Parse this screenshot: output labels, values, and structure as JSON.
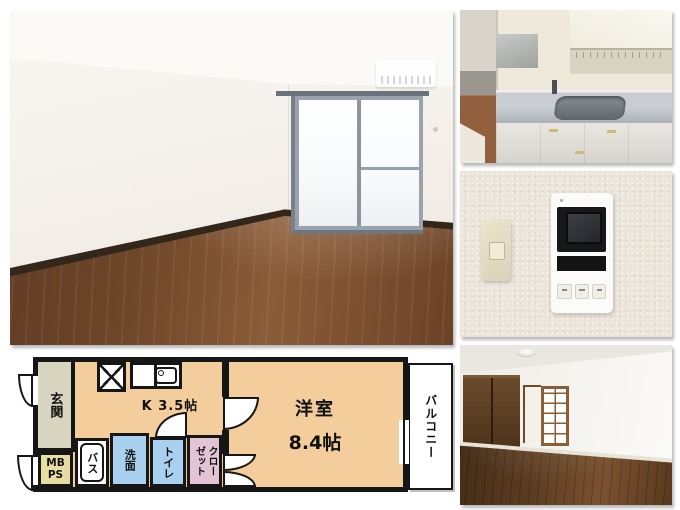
{
  "collage": {
    "background": "#ffffff",
    "sections": [
      "living-room-photo",
      "kitchen-photo",
      "intercom-photo",
      "bedroom-photo",
      "floor-plan"
    ]
  },
  "floorplan": {
    "labels": {
      "entrance": "玄関",
      "mb": "MB",
      "ps": "PS",
      "bath": "バス",
      "washroom": "洗面",
      "toilet": "トイレ",
      "closet_col_right": "クロー",
      "closet_col_left": "ゼット",
      "kitchen": "K 3.5帖",
      "room_name": "洋室",
      "room_size": "8.4帖",
      "balcony": "バルコニー"
    },
    "colors": {
      "wall": "#161616",
      "kitchen_room_fill": "#f3cd9b",
      "entrance_fill": "#d7d5bf",
      "mbps_fill": "#e5dda2",
      "wet_area_fill": "#a8d1ef",
      "closet_fill": "#e2c4d5",
      "balcony_fill": "#ffffff"
    }
  }
}
